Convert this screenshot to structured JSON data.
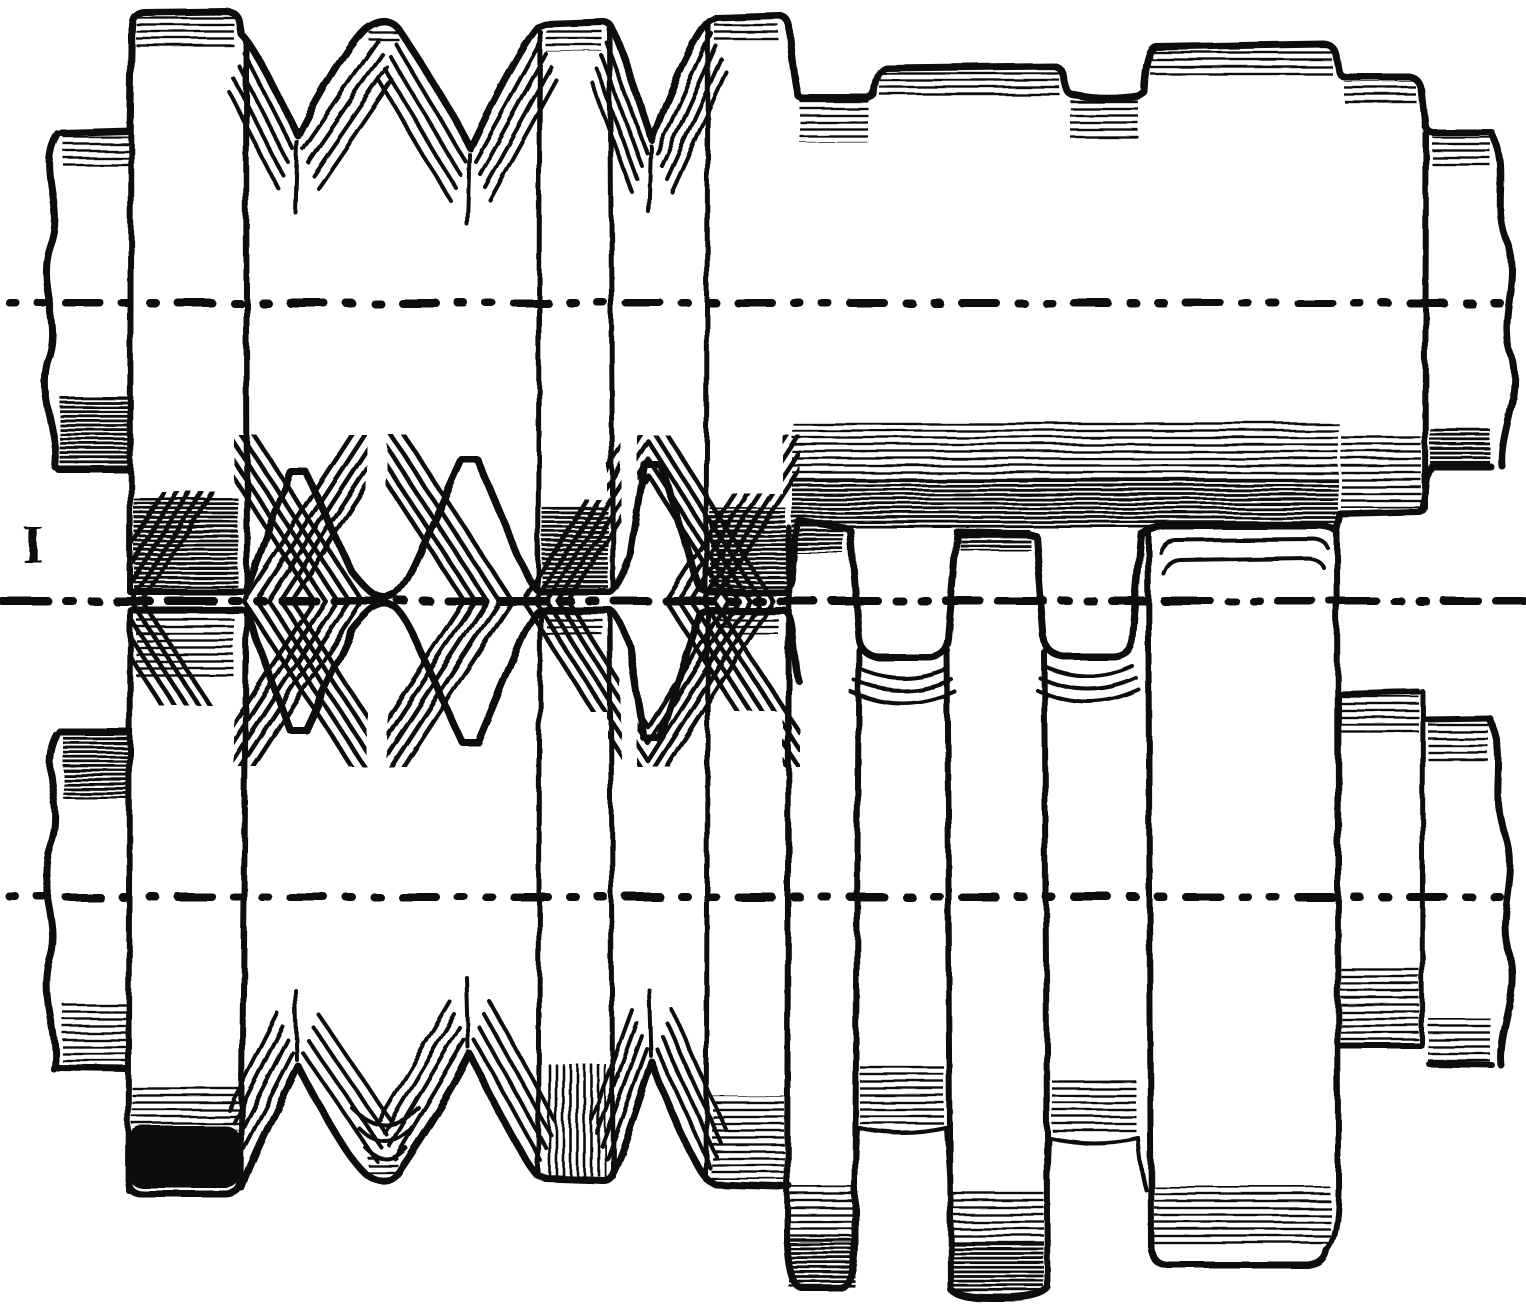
{
  "figure": {
    "title": "Engraving of two-high rolling mill rolls with diamond and box passes",
    "description": "Elevation view of a pair of mill rolls, one above the other. The left half of the roll barrels carries pointed V-collars forming diamond passes between the rolls; the right half carries rectangular collars and grooves forming box passes. Dash-dot centerlines mark the axis of each roll and the pass line between them; all four shaft ends are drawn broken with wavy break lines.",
    "style": "black-ink line engraving on white paper",
    "section_label": "I",
    "ink_color": "#101010",
    "background_color": "#ffffff",
    "centerlines": [
      {
        "name": "top-roll-axis",
        "kind": "dash-dot",
        "y": 303
      },
      {
        "name": "pass-line",
        "kind": "dash-dot",
        "y": 601
      },
      {
        "name": "bottom-roll-axis",
        "kind": "dash-dot",
        "y": 897
      }
    ],
    "rolls": [
      {
        "name": "top-roll",
        "shaft_ends": "broken (wavy break line) both sides"
      },
      {
        "name": "bottom-roll",
        "shaft_ends": "broken (wavy break line) both sides"
      }
    ],
    "left_section": {
      "pass_type": "diamond (V-groove) passes",
      "flat_collars": 3,
      "pointed_collars": 2,
      "diamond_openings": 2
    },
    "right_section": {
      "pass_type": "box (rectangular) passes",
      "box_collars": 2,
      "pass_openings": 2
    }
  }
}
